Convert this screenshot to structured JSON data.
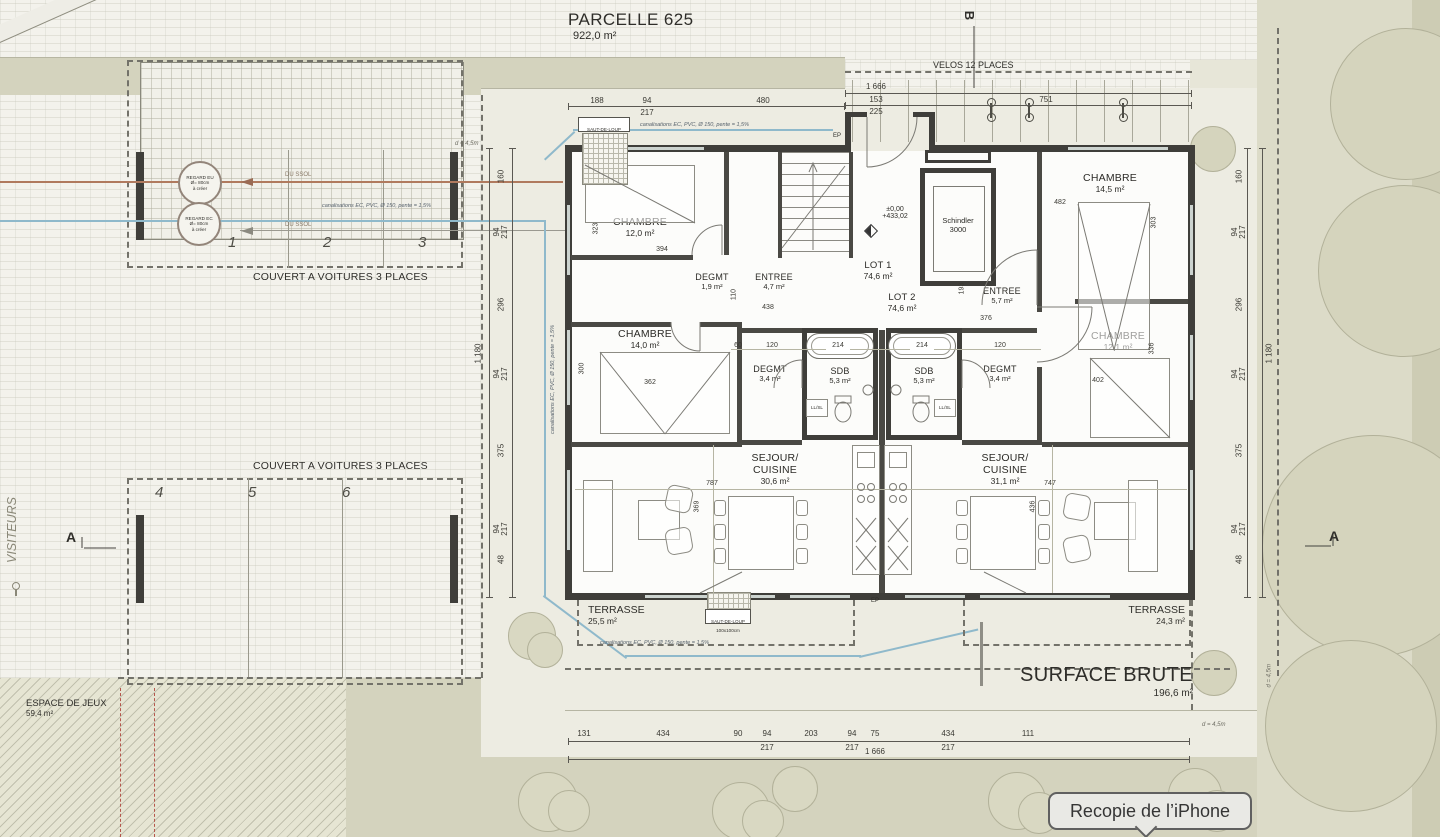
{
  "header": {
    "parcel_title": "PARCELLE 625",
    "parcel_area": "922,0 m²"
  },
  "site": {
    "velos_label": "VELOS 12 PLACES",
    "couvert_top": "COUVERT A VOITURES 3 PLACES",
    "couvert_bottom": "COUVERT A VOITURES 3 PLACES",
    "espace_jeux_label": "ESPACE DE JEUX",
    "espace_jeux_area": "59,4 m²",
    "visiteurs": "VISITEURS",
    "parking_top": [
      "1",
      "2",
      "3"
    ],
    "parking_bottom": [
      "4",
      "5",
      "6"
    ],
    "regard_eu": {
      "line1": "REGARD EU",
      "line2": "Ø= 80cm",
      "line3": "à créer"
    },
    "regard_ec": {
      "line1": "REGARD EC",
      "line2": "Ø= 80cm",
      "line3": "à créer"
    },
    "du_ssol": "DU SSOL",
    "canalisation": "canalisations EC, PVC, Ø 150, pente = 1,5%",
    "saut_de_loup_line1": "SAUT-DE-LOUP",
    "saut_de_loup_line2": "100x100cm",
    "ep": "EP",
    "d45": "d = 4,5m",
    "marker_a": "A",
    "marker_b": "B",
    "mirror_tooltip": "Recopie de l’iPhone"
  },
  "building": {
    "level_line1": "±0,00",
    "level_line2": "+433,02",
    "elevator_line1": "Schindler",
    "elevator_line2": "3000",
    "surface_brute_label": "SURFACE BRUTE",
    "surface_brute_area": "196,6 m²",
    "llsl": "LL/SL",
    "rooms": {
      "chambre1": {
        "name": "CHAMBRE",
        "area": "12,0 m²"
      },
      "chambre2": {
        "name": "CHAMBRE",
        "area": "14,0 m²"
      },
      "chambre3": {
        "name": "CHAMBRE",
        "area": "14,5 m²"
      },
      "chambre4": {
        "name": "CHAMBRE",
        "area": "12,1 m²"
      },
      "degmt1": {
        "name": "DEGMT",
        "area": "1,9 m²"
      },
      "degmt2": {
        "name": "DEGMT",
        "area": "3,4 m²"
      },
      "degmt3": {
        "name": "DEGMT",
        "area": "3,4 m²"
      },
      "entree1": {
        "name": "ENTREE",
        "area": "4,7 m²"
      },
      "entree2": {
        "name": "ENTREE",
        "area": "5,7 m²"
      },
      "lot1": {
        "name": "LOT 1",
        "area": "74,6 m²"
      },
      "lot2": {
        "name": "LOT 2",
        "area": "74,6 m²"
      },
      "sdb1": {
        "name": "SDB",
        "area": "5,3 m²"
      },
      "sdb2": {
        "name": "SDB",
        "area": "5,3 m²"
      },
      "sejour1": {
        "name1": "SEJOUR/",
        "name2": "CUISINE",
        "area": "30,6 m²"
      },
      "sejour2": {
        "name1": "SEJOUR/",
        "name2": "CUISINE",
        "area": "31,1 m²"
      },
      "terrasse1": {
        "name": "TERRASSE",
        "area": "25,5 m²"
      },
      "terrasse2": {
        "name": "TERRASSE",
        "area": "24,3 m²"
      }
    }
  },
  "dims": {
    "top": [
      "188",
      "94",
      "217",
      "480"
    ],
    "velos": [
      "1 666",
      "153",
      "225",
      "751"
    ],
    "bottom": [
      "131",
      "434",
      "90",
      "94",
      "217",
      "203",
      "94",
      "217",
      "75",
      "434",
      "217",
      "111"
    ],
    "bottom_total": "1 666",
    "left": [
      "160",
      "94",
      "217",
      "296",
      "94",
      "217",
      "375",
      "94",
      "217",
      "48"
    ],
    "left_total": "1 180",
    "right": [
      "160",
      "94",
      "217",
      "296",
      "94",
      "217",
      "375",
      "94",
      "217",
      "48"
    ],
    "right_total": "1 180",
    "interior": {
      "d323": "323",
      "d394": "394",
      "d438": "438",
      "d110": "110",
      "d482": "482",
      "d303": "303",
      "d336": "336",
      "d402": "402",
      "d362": "362",
      "d300": "300",
      "d193": "193",
      "d376": "376",
      "d214a": "214",
      "d214b": "214",
      "d120a": "120",
      "d120b": "120",
      "d60": "60",
      "d787": "787",
      "d369": "369",
      "d747": "747",
      "d436": "436"
    }
  }
}
